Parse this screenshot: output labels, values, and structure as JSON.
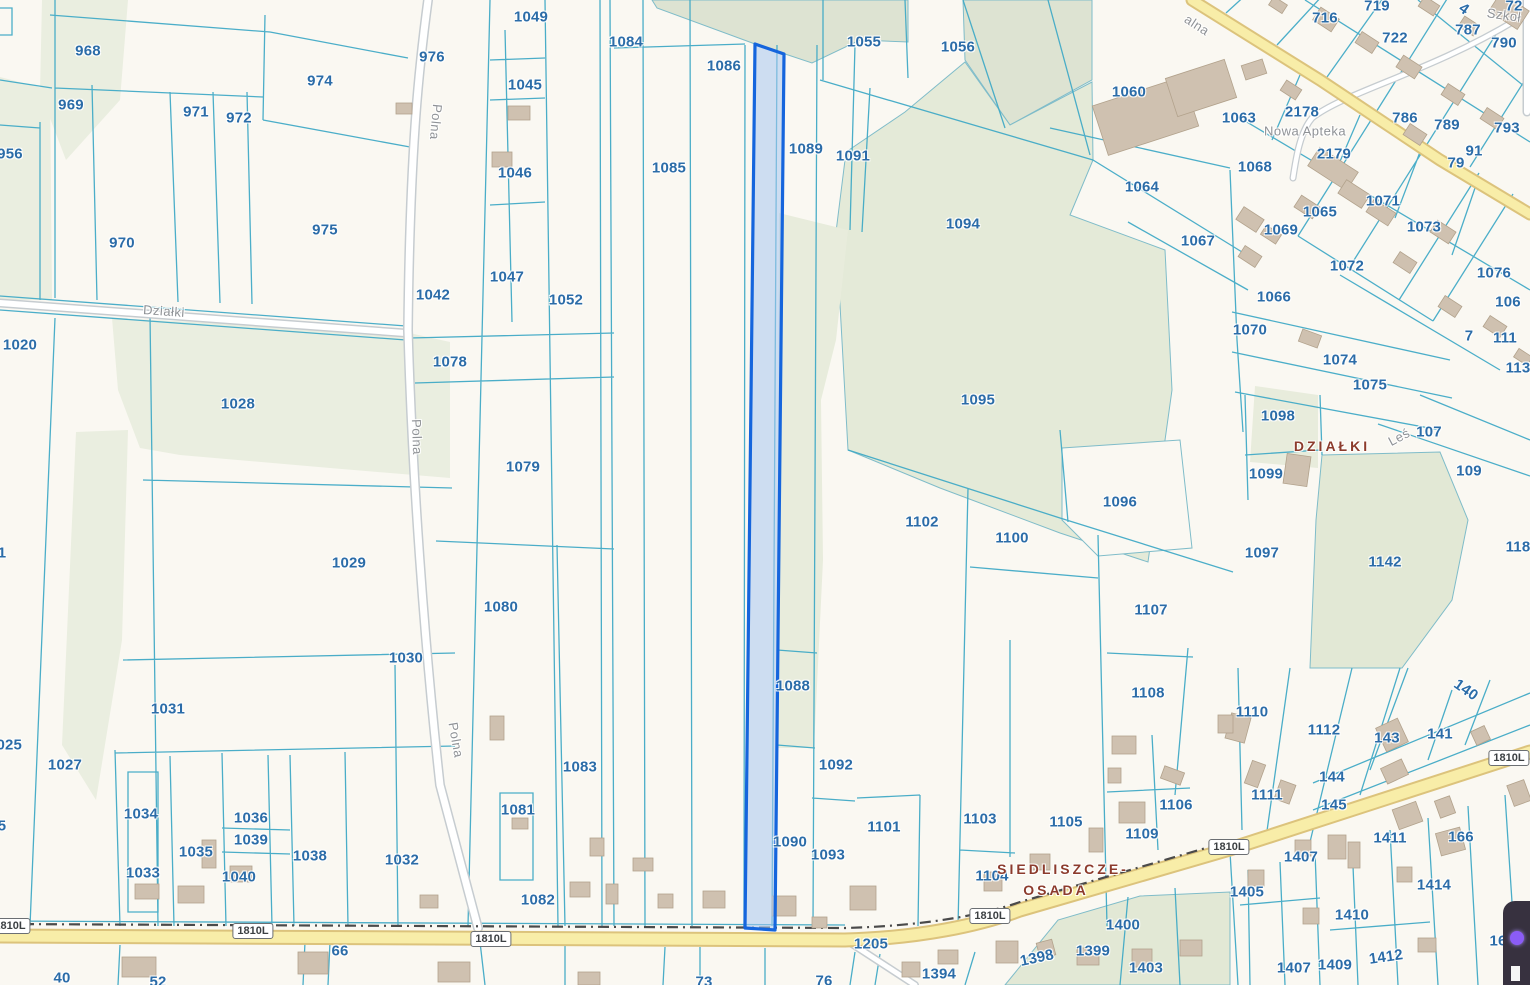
{
  "map": {
    "colors": {
      "background": "#faf8f2",
      "parcel_line": "#41aac6",
      "parcel_label": "#2b6ca8",
      "place_label": "#8c3b2c",
      "street_label": "#8f9296",
      "road_yellow": "#f8eda8",
      "road_casing": "#dcc37c",
      "green_area": "#e4e9d9",
      "building_fill": "#cfc1b0",
      "building_stroke": "#b2a28c",
      "highlight_fill": "#a8c6f0",
      "highlight_stroke": "#1565dd"
    },
    "parcel_labels": [
      [
        "968",
        88,
        51
      ],
      [
        "969",
        71,
        105
      ],
      [
        "971",
        196,
        112
      ],
      [
        "972",
        239,
        118
      ],
      [
        "974",
        320,
        81
      ],
      [
        "976",
        432,
        57
      ],
      [
        "956",
        10,
        154
      ],
      [
        "970",
        122,
        243
      ],
      [
        "975",
        325,
        230
      ],
      [
        "1042",
        433,
        295
      ],
      [
        "1049",
        531,
        17
      ],
      [
        "1045",
        525,
        85
      ],
      [
        "1046",
        515,
        173
      ],
      [
        "1047",
        507,
        277
      ],
      [
        "1052",
        566,
        300
      ],
      [
        "1084",
        626,
        42
      ],
      [
        "1086",
        724,
        66
      ],
      [
        "1085",
        669,
        168
      ],
      [
        "1089",
        806,
        149
      ],
      [
        "1055",
        864,
        42
      ],
      [
        "1056",
        958,
        47
      ],
      [
        "1091",
        853,
        156
      ],
      [
        "1060",
        1129,
        92
      ],
      [
        "1063",
        1239,
        118
      ],
      [
        "1064",
        1142,
        187
      ],
      [
        "1067",
        1198,
        241
      ],
      [
        "1094",
        963,
        224
      ],
      [
        "1095",
        978,
        400
      ],
      [
        "1096",
        1120,
        502
      ],
      [
        "2178",
        1302,
        112
      ],
      [
        "2179",
        1334,
        154
      ],
      [
        "1068",
        1255,
        167
      ],
      [
        "1065",
        1320,
        212
      ],
      [
        "1069",
        1281,
        230
      ],
      [
        "1071",
        1383,
        201
      ],
      [
        "1073",
        1424,
        227
      ],
      [
        "1072",
        1347,
        266
      ],
      [
        "1066",
        1274,
        297
      ],
      [
        "1070",
        1250,
        330
      ],
      [
        "1074",
        1340,
        360
      ],
      [
        "1075",
        1370,
        385
      ],
      [
        "716",
        1325,
        18
      ],
      [
        "719",
        1377,
        6
      ],
      [
        "722",
        1395,
        38
      ],
      [
        "787",
        1468,
        30
      ],
      [
        "790",
        1504,
        43
      ],
      [
        "786",
        1405,
        118
      ],
      [
        "789",
        1447,
        125
      ],
      [
        "793",
        1507,
        128
      ],
      [
        "91",
        1474,
        151
      ],
      [
        "79",
        1456,
        163
      ],
      [
        "72",
        1514,
        6
      ],
      [
        "4",
        1464,
        9,
        35
      ],
      [
        "1076",
        1494,
        273
      ],
      [
        "106",
        1508,
        302
      ],
      [
        "111",
        1505,
        338
      ],
      [
        "113",
        1518,
        368
      ],
      [
        "7",
        1469,
        336
      ],
      [
        "107",
        1429,
        432
      ],
      [
        "109",
        1469,
        471
      ],
      [
        "118",
        1518,
        547
      ],
      [
        "1098",
        1278,
        416
      ],
      [
        "1099",
        1266,
        474
      ],
      [
        "1097",
        1262,
        553
      ],
      [
        "1142",
        1385,
        562
      ],
      [
        "1020",
        20,
        345
      ],
      [
        "1028",
        238,
        404
      ],
      [
        "1029",
        349,
        563
      ],
      [
        "1030",
        406,
        658
      ],
      [
        "1031",
        168,
        709
      ],
      [
        "1027",
        65,
        765
      ],
      [
        "1025",
        5,
        745
      ],
      [
        "1",
        2,
        553
      ],
      [
        "5",
        2,
        826
      ],
      [
        "1078",
        450,
        362
      ],
      [
        "1079",
        523,
        467
      ],
      [
        "1080",
        501,
        607
      ],
      [
        "1083",
        580,
        767
      ],
      [
        "1081",
        518,
        810
      ],
      [
        "1082",
        538,
        900
      ],
      [
        "1102",
        922,
        522
      ],
      [
        "1100",
        1012,
        538
      ],
      [
        "1107",
        1151,
        610
      ],
      [
        "1108",
        1148,
        693
      ],
      [
        "1088",
        793,
        686
      ],
      [
        "1090",
        790,
        842
      ],
      [
        "1092",
        836,
        765
      ],
      [
        "1093",
        828,
        855
      ],
      [
        "1101",
        884,
        827
      ],
      [
        "1033",
        143,
        873
      ],
      [
        "1034",
        141,
        814
      ],
      [
        "1035",
        196,
        852
      ],
      [
        "1036",
        251,
        818
      ],
      [
        "1039",
        251,
        840
      ],
      [
        "1040",
        239,
        877
      ],
      [
        "1038",
        310,
        856
      ],
      [
        "1032",
        402,
        860
      ],
      [
        "1103",
        980,
        819
      ],
      [
        "1104",
        992,
        876
      ],
      [
        "1105",
        1066,
        822
      ],
      [
        "1106",
        1176,
        805
      ],
      [
        "1109",
        1142,
        834
      ],
      [
        "1110",
        1252,
        712
      ],
      [
        "1112",
        1324,
        730
      ],
      [
        "1111",
        1267,
        795
      ],
      [
        "144",
        1332,
        777
      ],
      [
        "145",
        1334,
        805
      ],
      [
        "143",
        1387,
        738
      ],
      [
        "141",
        1440,
        734
      ],
      [
        "140",
        1466,
        690,
        35
      ],
      [
        "166",
        1461,
        837
      ],
      [
        "1411",
        1390,
        838
      ],
      [
        "1414",
        1434,
        885
      ],
      [
        "1405",
        1247,
        892
      ],
      [
        "1407",
        1301,
        857
      ],
      [
        "1407",
        1294,
        968
      ],
      [
        "1409",
        1335,
        965
      ],
      [
        "1410",
        1352,
        915
      ],
      [
        "1412",
        1386,
        957,
        -8
      ],
      [
        "16",
        1498,
        941
      ],
      [
        "1205",
        871,
        944
      ],
      [
        "1394",
        939,
        974
      ],
      [
        "1398",
        1037,
        958,
        -12
      ],
      [
        "1399",
        1093,
        951
      ],
      [
        "1400",
        1123,
        925
      ],
      [
        "1403",
        1146,
        968
      ],
      [
        "66",
        340,
        951
      ],
      [
        "40",
        62,
        978
      ],
      [
        "52",
        158,
        982
      ],
      [
        "73",
        704,
        982
      ],
      [
        "76",
        824,
        981
      ]
    ],
    "street_labels": [
      [
        "Polna",
        436,
        122,
        95
      ],
      [
        "Polna",
        417,
        437,
        88
      ],
      [
        "Polna",
        456,
        740,
        80
      ],
      [
        "Działki",
        164,
        311,
        4
      ],
      [
        "Leś",
        1399,
        437,
        -28
      ],
      [
        "alna",
        1197,
        25,
        33
      ],
      [
        "Szkoł",
        1504,
        15,
        8
      ],
      [
        "Nowa Apteka",
        1305,
        131,
        0
      ]
    ],
    "place_labels": [
      [
        "SIEDLISZCZE-",
        1063,
        869
      ],
      [
        "OSADA",
        1056,
        890
      ],
      [
        "DZIAŁKI",
        1332,
        446
      ]
    ],
    "road_badges": [
      [
        "1810L",
        10,
        926
      ],
      [
        "1810L",
        253,
        931
      ],
      [
        "1810L",
        491,
        939
      ],
      [
        "1810L",
        990,
        916
      ],
      [
        "1810L",
        1229,
        847
      ],
      [
        "1810L",
        1509,
        758
      ]
    ],
    "buildings": [
      [
        1315,
        12,
        22,
        15,
        33
      ],
      [
        1357,
        36,
        20,
        13,
        33
      ],
      [
        1398,
        60,
        22,
        14,
        33
      ],
      [
        1443,
        88,
        20,
        13,
        33
      ],
      [
        1482,
        112,
        20,
        13,
        33
      ],
      [
        1270,
        0,
        16,
        10,
        33
      ],
      [
        1420,
        0,
        18,
        12,
        33
      ],
      [
        1460,
        20,
        18,
        12,
        33
      ],
      [
        1492,
        0,
        34,
        22,
        33
      ],
      [
        1282,
        84,
        18,
        12,
        33
      ],
      [
        1310,
        158,
        46,
        22,
        33
      ],
      [
        1340,
        186,
        28,
        16,
        33
      ],
      [
        1296,
        200,
        22,
        14,
        33
      ],
      [
        1238,
        212,
        24,
        15,
        33
      ],
      [
        1262,
        229,
        18,
        11,
        33
      ],
      [
        1368,
        205,
        26,
        15,
        33
      ],
      [
        1405,
        128,
        20,
        13,
        33
      ],
      [
        1432,
        225,
        22,
        14,
        33
      ],
      [
        1395,
        256,
        20,
        13,
        33
      ],
      [
        1440,
        300,
        20,
        13,
        33
      ],
      [
        1485,
        320,
        20,
        13,
        33
      ],
      [
        1515,
        352,
        16,
        10,
        33
      ],
      [
        1300,
        332,
        20,
        13,
        20
      ],
      [
        1240,
        250,
        20,
        13,
        33
      ],
      [
        1098,
        90,
        95,
        52,
        -18
      ],
      [
        1170,
        68,
        62,
        40,
        -18
      ],
      [
        1243,
        62,
        22,
        15,
        -18
      ],
      [
        1285,
        455,
        24,
        30,
        8
      ],
      [
        396,
        103,
        16,
        11,
        0
      ],
      [
        508,
        106,
        22,
        14,
        0
      ],
      [
        492,
        152,
        20,
        15,
        0
      ],
      [
        512,
        818,
        16,
        11,
        0
      ],
      [
        135,
        884,
        24,
        15,
        0
      ],
      [
        178,
        886,
        26,
        17,
        0
      ],
      [
        122,
        957,
        34,
        20,
        0
      ],
      [
        202,
        840,
        14,
        28,
        0
      ],
      [
        230,
        866,
        22,
        16,
        0
      ],
      [
        420,
        895,
        18,
        13,
        0
      ],
      [
        570,
        882,
        20,
        15,
        0
      ],
      [
        606,
        884,
        12,
        20,
        0
      ],
      [
        658,
        894,
        15,
        14,
        0
      ],
      [
        703,
        891,
        22,
        17,
        0
      ],
      [
        772,
        896,
        24,
        20,
        0
      ],
      [
        812,
        917,
        15,
        11,
        0
      ],
      [
        850,
        886,
        26,
        24,
        0
      ],
      [
        490,
        716,
        14,
        24,
        0
      ],
      [
        590,
        838,
        14,
        18,
        0
      ],
      [
        633,
        858,
        20,
        13,
        0
      ],
      [
        438,
        962,
        32,
        20,
        0
      ],
      [
        298,
        952,
        30,
        22,
        0
      ],
      [
        578,
        972,
        22,
        13,
        0
      ],
      [
        902,
        962,
        18,
        15,
        0
      ],
      [
        938,
        950,
        20,
        14,
        0
      ],
      [
        996,
        941,
        22,
        22,
        0
      ],
      [
        1077,
        948,
        22,
        17,
        0
      ],
      [
        1132,
        949,
        20,
        18,
        0
      ],
      [
        1038,
        941,
        16,
        16,
        -15
      ],
      [
        1180,
        940,
        22,
        16,
        0
      ],
      [
        1228,
        715,
        20,
        26,
        15
      ],
      [
        1248,
        762,
        14,
        24,
        20
      ],
      [
        1277,
        782,
        16,
        20,
        20
      ],
      [
        1328,
        835,
        18,
        24,
        0
      ],
      [
        1295,
        840,
        16,
        16,
        0
      ],
      [
        1380,
        722,
        24,
        26,
        -25
      ],
      [
        1383,
        763,
        23,
        17,
        -25
      ],
      [
        1395,
        805,
        25,
        21,
        -20
      ],
      [
        1437,
        798,
        16,
        18,
        -20
      ],
      [
        1473,
        728,
        15,
        15,
        -25
      ],
      [
        1510,
        782,
        18,
        22,
        -20
      ],
      [
        1438,
        830,
        25,
        23,
        -15
      ],
      [
        1248,
        870,
        16,
        16,
        0
      ],
      [
        1303,
        908,
        16,
        16,
        0
      ],
      [
        1348,
        842,
        12,
        26,
        0
      ],
      [
        1397,
        867,
        15,
        15,
        0
      ],
      [
        1418,
        938,
        18,
        14,
        0
      ],
      [
        1112,
        736,
        24,
        18,
        0
      ],
      [
        1108,
        768,
        13,
        15,
        0
      ],
      [
        1119,
        802,
        26,
        21,
        0
      ],
      [
        1162,
        769,
        21,
        13,
        20
      ],
      [
        1218,
        715,
        15,
        18,
        0
      ],
      [
        1089,
        828,
        14,
        24,
        0
      ],
      [
        984,
        872,
        18,
        19,
        0
      ],
      [
        1030,
        854,
        20,
        16,
        0
      ]
    ]
  }
}
